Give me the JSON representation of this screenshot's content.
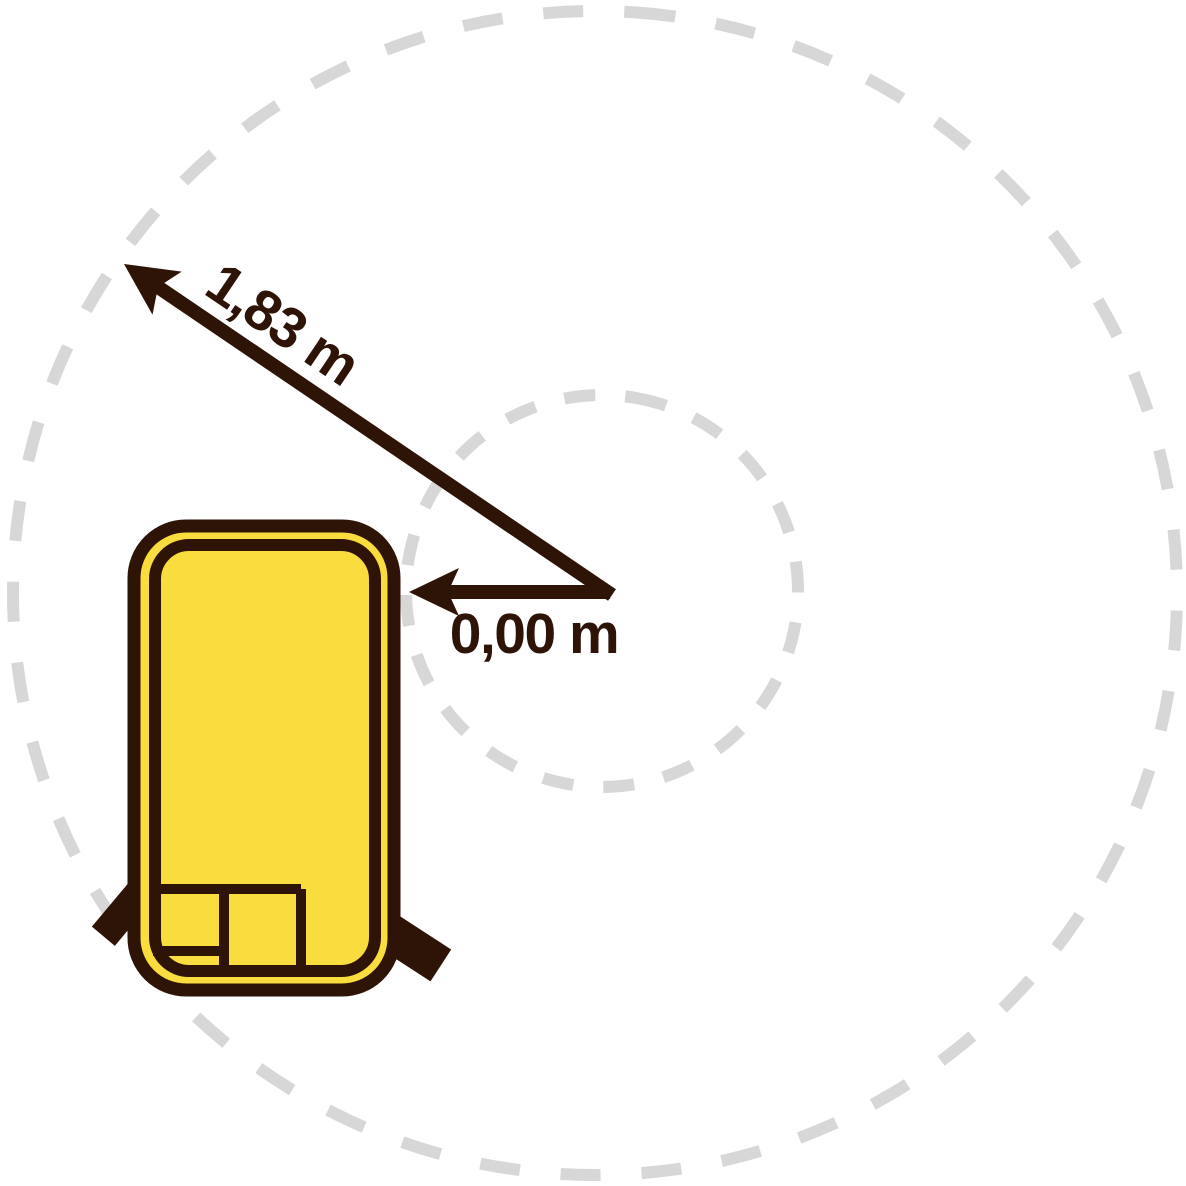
{
  "diagram": {
    "outer_radius_label": "1,83 m",
    "inner_radius_label": "0,00 m",
    "colors": {
      "machine_yellow": "#F9DC3E",
      "outline_dark_brown": "#2E1307",
      "dashed_circle_gray": "#D7D7D7",
      "background": "#FFFFFF"
    }
  }
}
